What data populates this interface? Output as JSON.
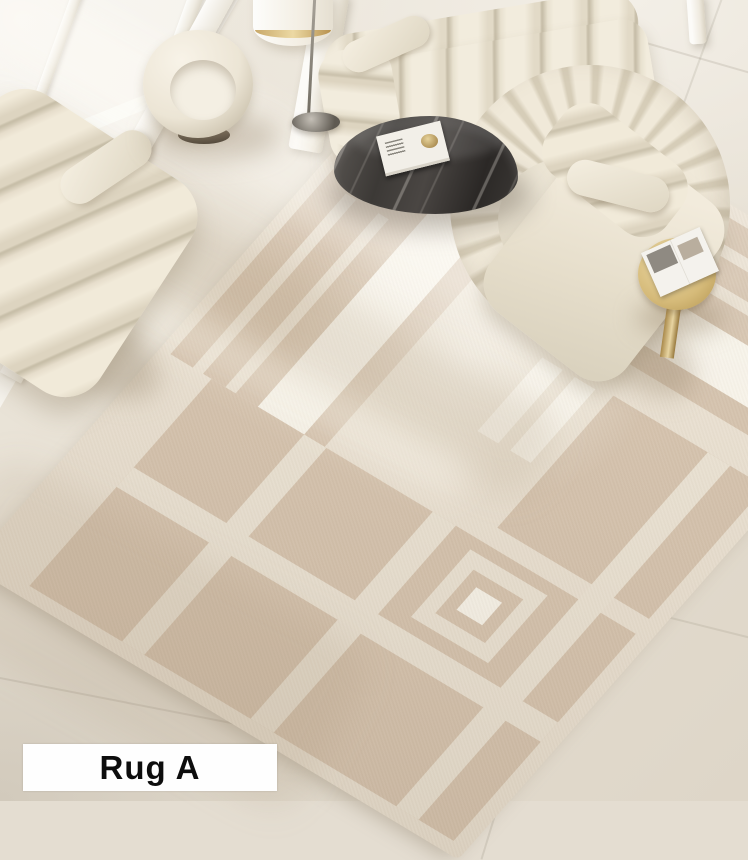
{
  "label": {
    "text": "Rug A"
  },
  "palette": {
    "floor": "#e4ddd1",
    "window_glass": "#f6f3ed",
    "rug_tan": "#d5c3ae",
    "rug_cream": "#eae2d3",
    "rug_white": "#f7f3e9",
    "sofa_cream": "#f2ecdd",
    "sofa_shadow": "#c8bfaa",
    "stone_table_dark": "#3a3836",
    "stone_table_vein": "#d8d3cb",
    "gold_accent": "#d8c28d",
    "armchair_base": "#64584a",
    "label_background": "#fefefe",
    "label_text": "#0d0d0d"
  }
}
